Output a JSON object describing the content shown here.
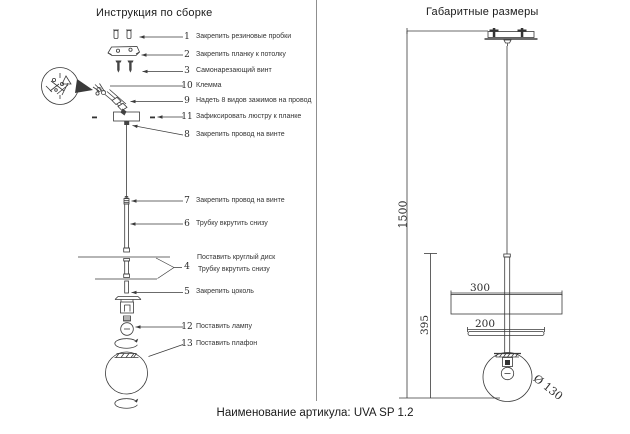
{
  "left_panel": {
    "title": "Инструкция по сборке",
    "callouts": [
      {
        "num": "1",
        "label": "Закрепить резиновые пробки"
      },
      {
        "num": "2",
        "label": "Закрепить планку к потолку"
      },
      {
        "num": "3",
        "label": "Самонарезающий винт"
      },
      {
        "num": "10",
        "label": "Клемма"
      },
      {
        "num": "9",
        "label": "Надеть 8 видов зажимов на провод"
      },
      {
        "num": "11",
        "label": "Зафиксировать люстру к планке"
      },
      {
        "num": "8",
        "label": "Закрепить провод на винте"
      },
      {
        "num": "7",
        "label": "Закрепить провод на винте"
      },
      {
        "num": "6",
        "label": "Трубку вкрутить снизу"
      },
      {
        "num": "4",
        "label": "Поставить круглый диск",
        "label2": "Трубку вкрутить снизу"
      },
      {
        "num": "5",
        "label": "Закрепить цоколь"
      },
      {
        "num": "12",
        "label": "Поставить лампу"
      },
      {
        "num": "13",
        "label": "Поставить плафон"
      }
    ]
  },
  "right_panel": {
    "title": "Габаритные размеры",
    "dimensions": {
      "height_total": "1500",
      "height_fixture": "395",
      "disk_large": "300",
      "disk_small": "200",
      "sphere_diameter": "Ø 130"
    }
  },
  "footer": {
    "article_label": "Наименование артикула: UVA SP 1.2"
  },
  "colors": {
    "line": "#3a3a3a",
    "text": "#222222",
    "divider": "#8f8f8f"
  }
}
